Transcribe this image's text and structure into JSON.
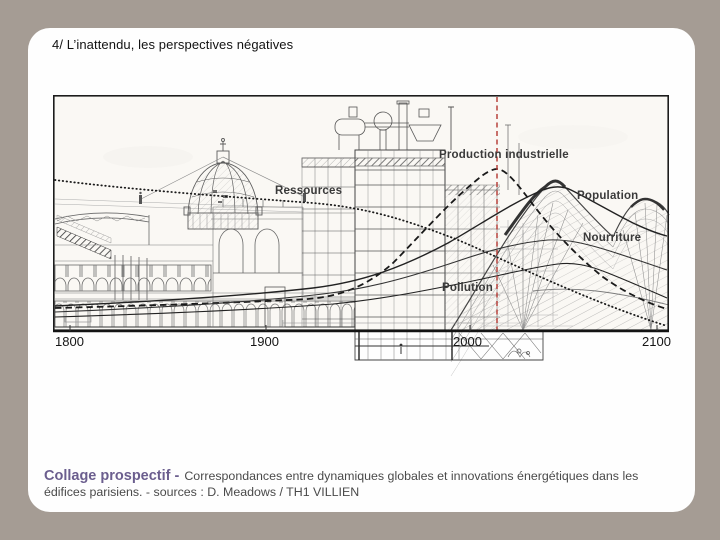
{
  "slide": {
    "title": "4/ L’inattendu, les perspectives négatives",
    "background_color": "#a59c94",
    "card_color": "#fefefe"
  },
  "figure": {
    "paper_color": "#faf8f4",
    "frame_color": "#1c1c1c",
    "red_marker_color": "#b23530",
    "curve_color": "#1a1a1a",
    "labels": {
      "ressources": "Ressources",
      "production": "Production industrielle",
      "population": "Population",
      "nourriture": "Nourriture",
      "pollution": "Pollution"
    },
    "timeline_years": [
      "1800",
      "1900",
      "2000",
      "2100"
    ]
  },
  "caption": {
    "lead": "Collage prospectif -",
    "lead_color": "#6b5e8e",
    "body_line1": "Correspondances entre dynamiques globales et innovations énergétiques dans les",
    "body_line2": "édifices parisiens.  - sources : D. Meadows / TH1 VILLIEN"
  }
}
